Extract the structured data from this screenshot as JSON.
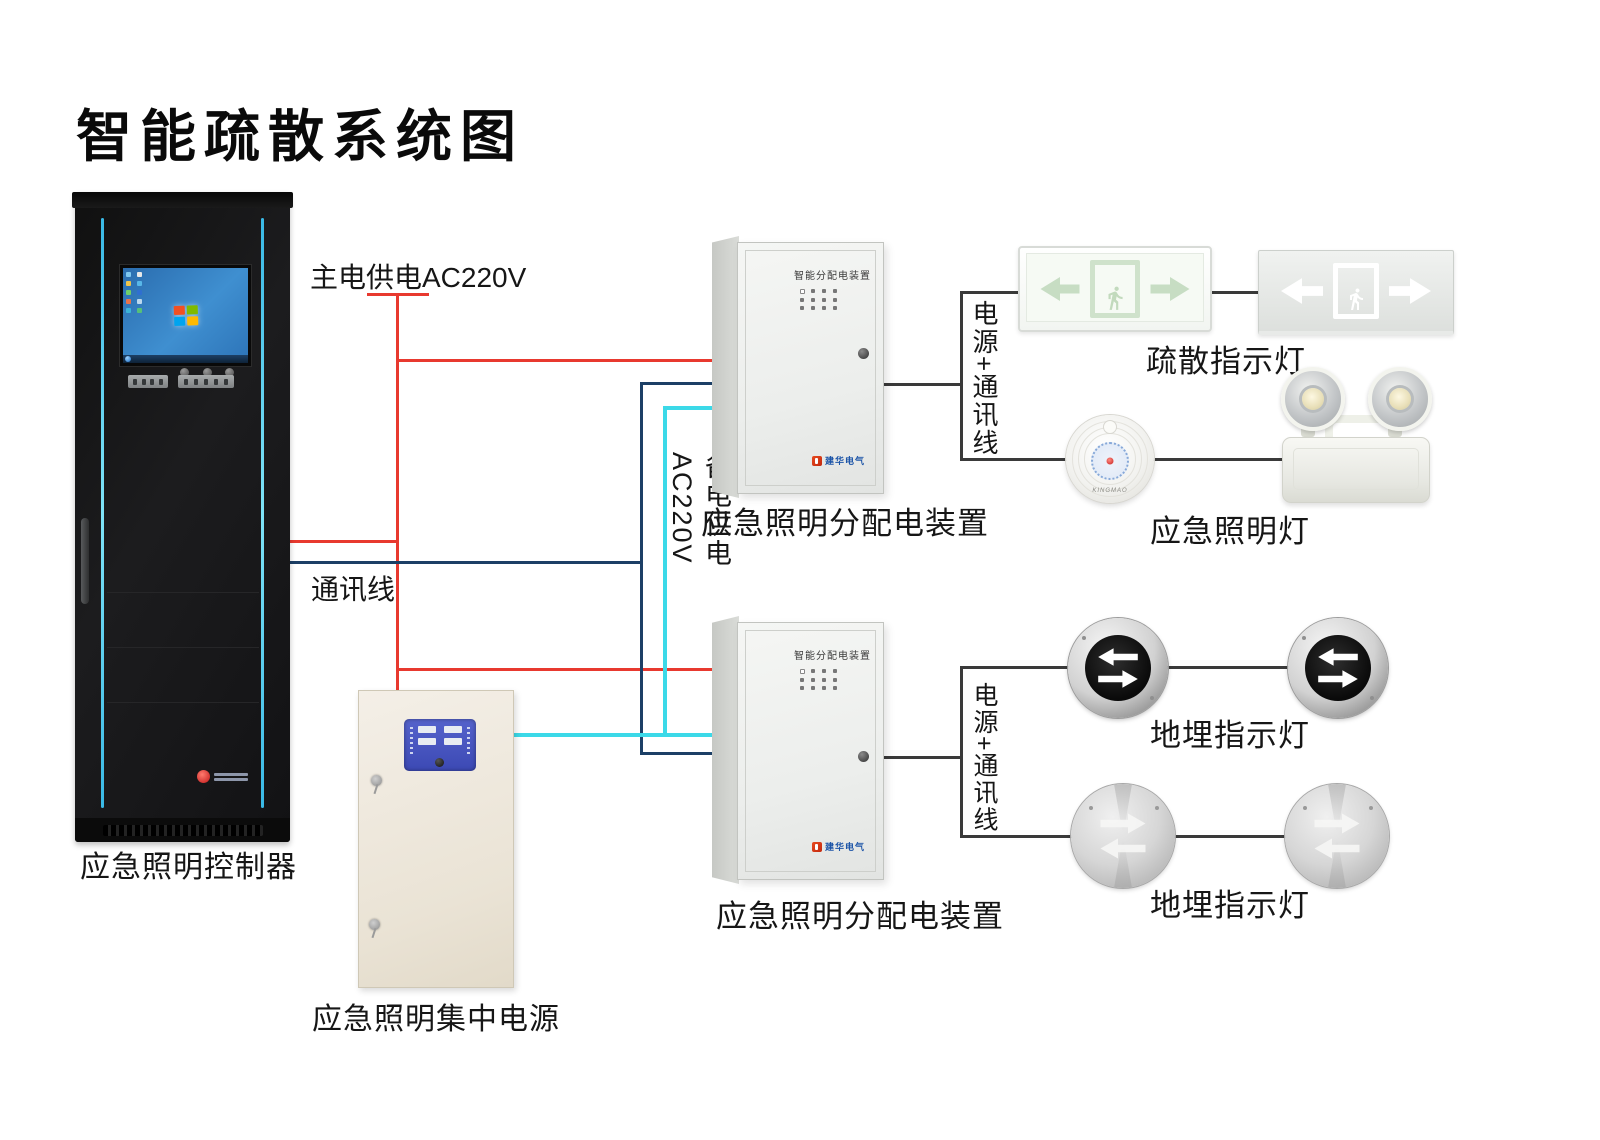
{
  "title": "智能疏散系统图",
  "wire_labels": {
    "main_power": "主电供电AC220V",
    "comm": "通讯线",
    "backup_power": "备电供电AC220V",
    "power_comm_top": "电源+通讯线",
    "power_comm_bottom": "电源+通讯线"
  },
  "device_labels": {
    "controller": "应急照明控制器",
    "psu": "应急照明集中电源",
    "dist_box_top": "应急照明分配电装置",
    "dist_box_bottom": "应急照明分配电装置",
    "exit_signs": "疏散指示灯",
    "emergency_lights": "应急照明灯",
    "ground_lights_top": "地埋指示灯",
    "ground_lights_bottom": "地埋指示灯"
  },
  "device_details": {
    "dist_box_door_text": "智能分配电装置",
    "dist_box_logo_text": "建华电气",
    "round_lamp_brand": "KINGMAO"
  },
  "wire_colors": {
    "main_power": "#e8392f",
    "comm": "#1c3f66",
    "backup_power": "#3bd9e8",
    "device_link": "#3a3a3a"
  }
}
